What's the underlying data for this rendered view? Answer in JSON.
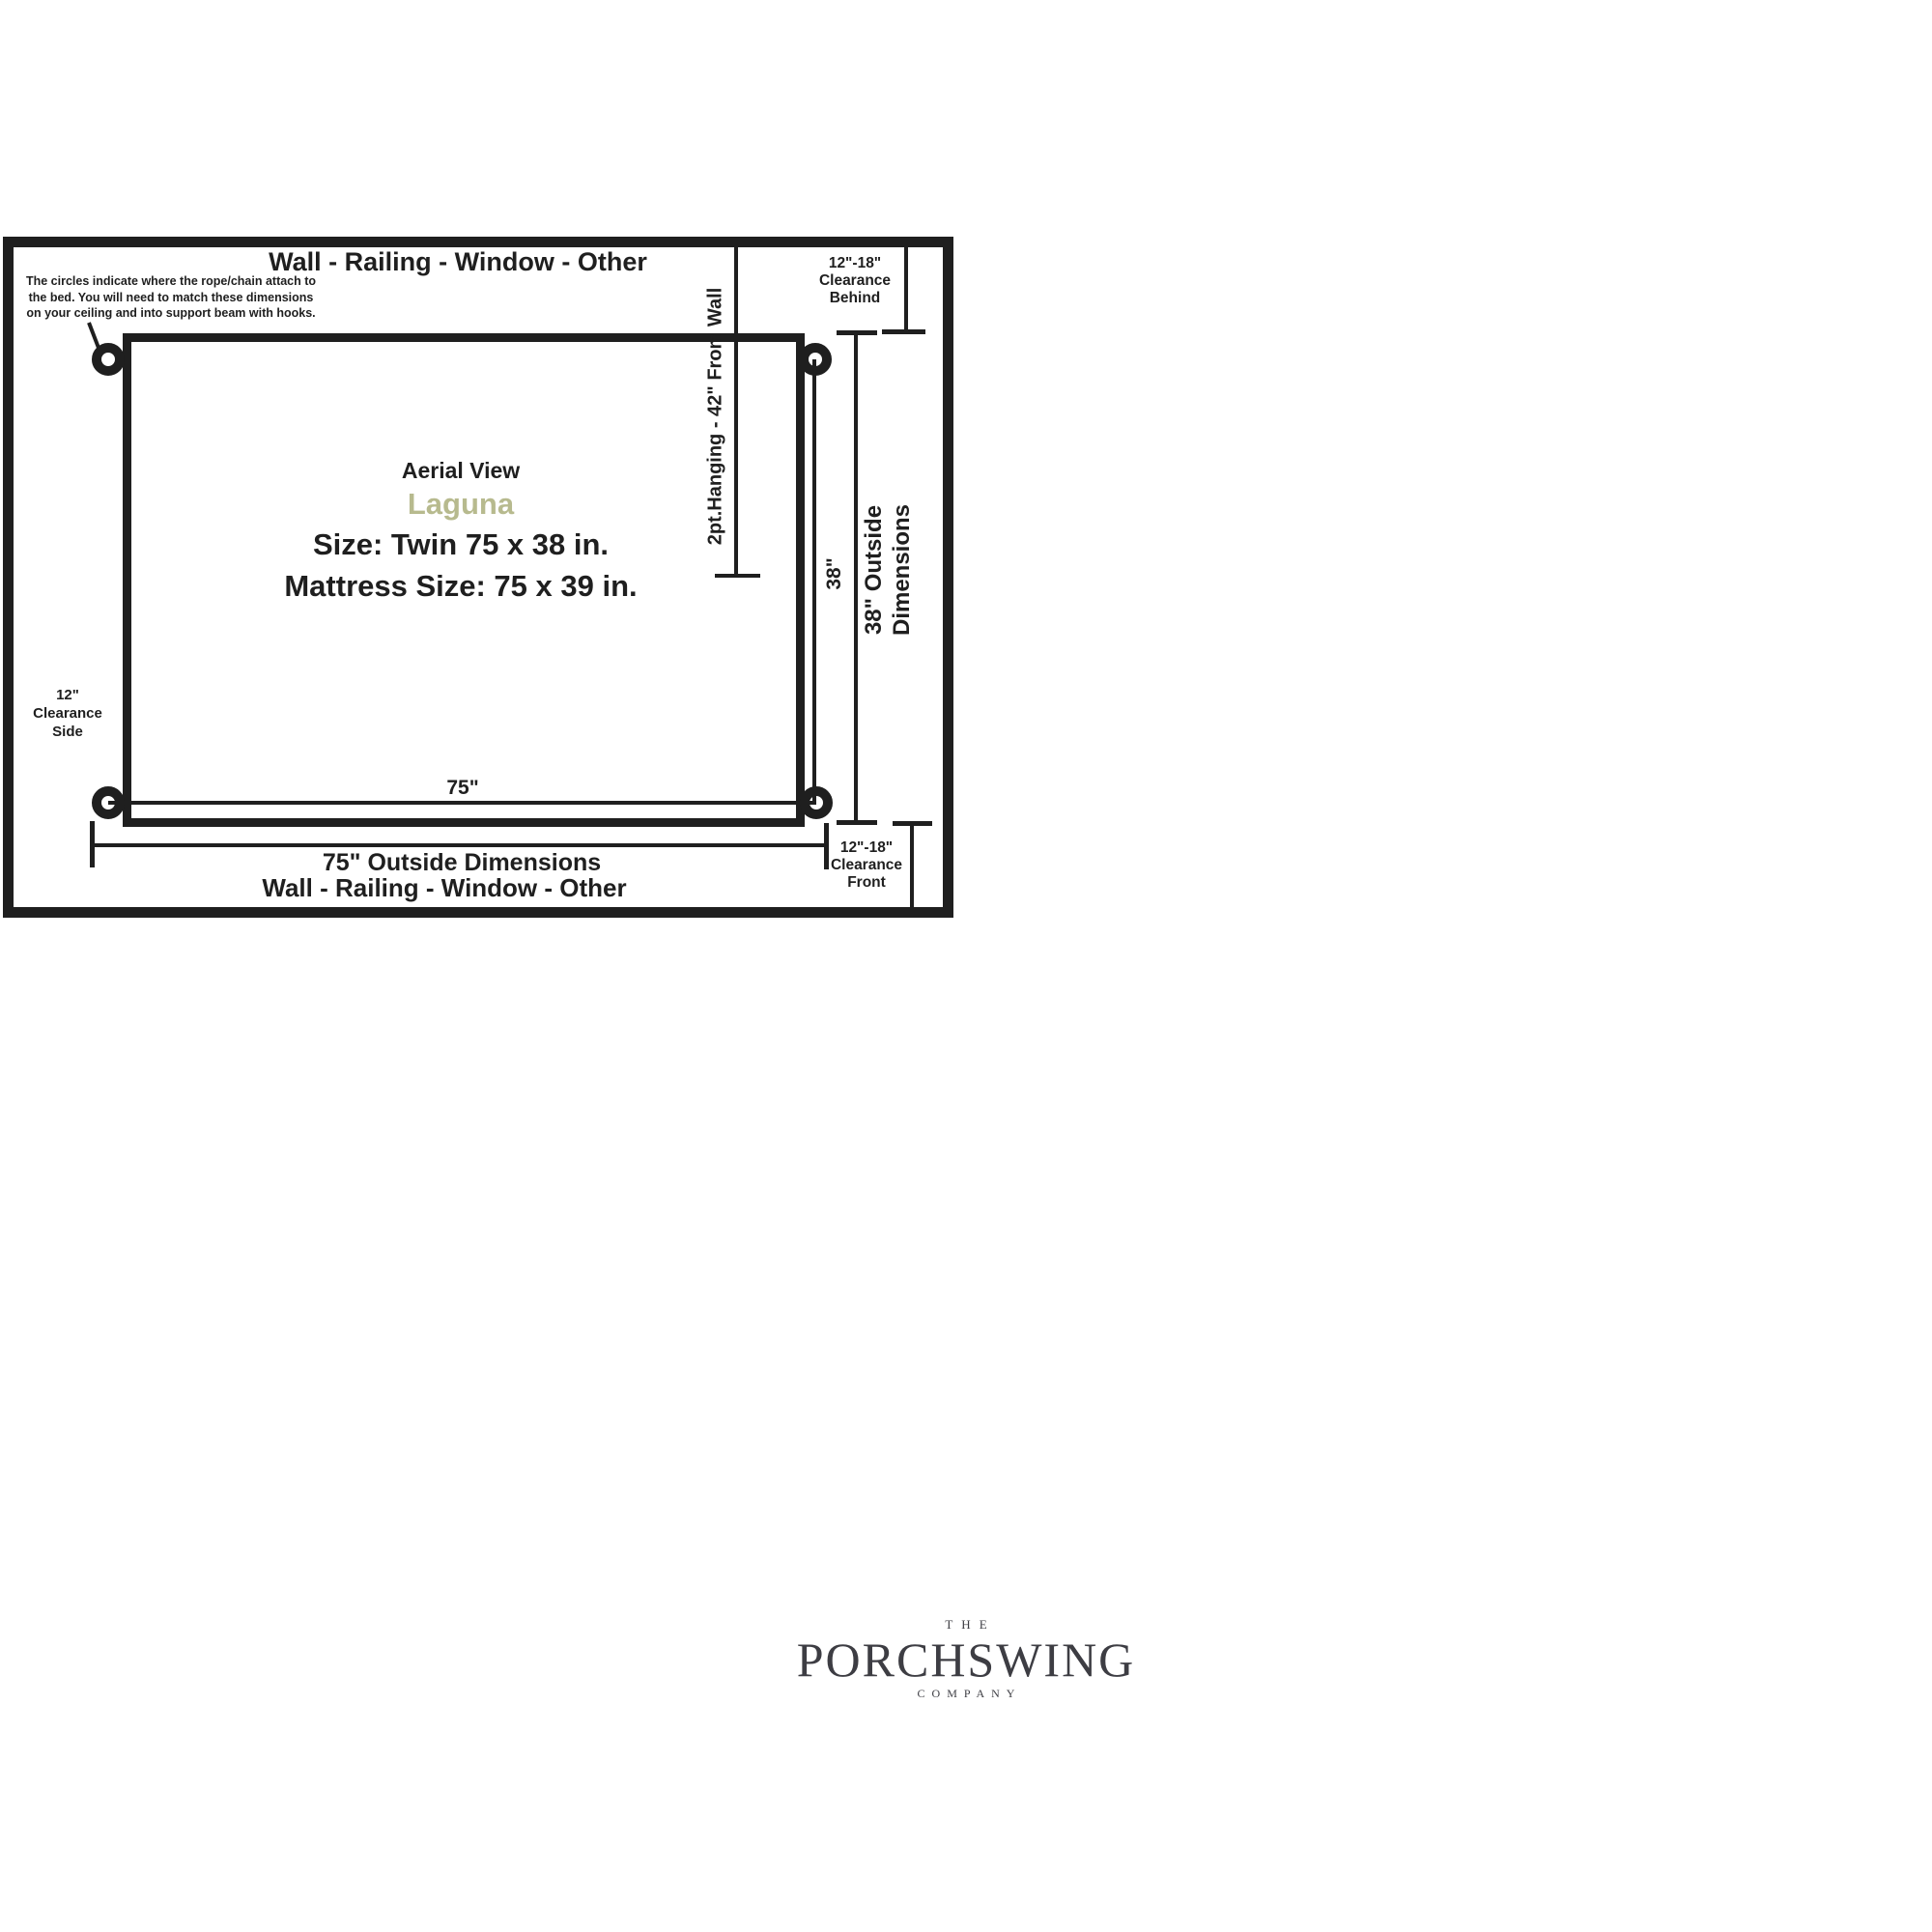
{
  "diagram": {
    "wall_label_top": "Wall - Railing - Window - Other",
    "wall_label_bottom": "Wall - Railing - Window - Other",
    "annotation_lines": [
      "The circles indicate where the rope/chain attach to",
      "the bed. You will need to match these dimensions",
      "on your ceiling and into support beam with hooks."
    ],
    "hanging_label": "2pt.Hanging - 42\" From Wall",
    "clearance_behind": [
      "12\"-18\"",
      "Clearance",
      "Behind"
    ],
    "clearance_front": [
      "12\"-18\"",
      "Clearance",
      "Front"
    ],
    "clearance_side": [
      "12\"",
      "Clearance",
      "Side"
    ],
    "center": {
      "view_label": "Aerial View",
      "product_name": "Laguna",
      "size_line": "Size: Twin 75 x 38 in.",
      "mattress_line": "Mattress Size: 75 x 39 in."
    },
    "width_inner_label": "75\"",
    "depth_inner_label": "38\"",
    "width_outside_label": "75\" Outside Dimensions",
    "depth_outside_lines": [
      "38\" Outside",
      "Dimensions"
    ],
    "colors": {
      "ink": "#1f1f1f",
      "product_accent": "#b7ba8e",
      "logo_gray": "#3d3d43"
    }
  },
  "logo": {
    "top_word": "THE",
    "name": "PORCHSWING",
    "bottom_word": "COMPANY"
  }
}
